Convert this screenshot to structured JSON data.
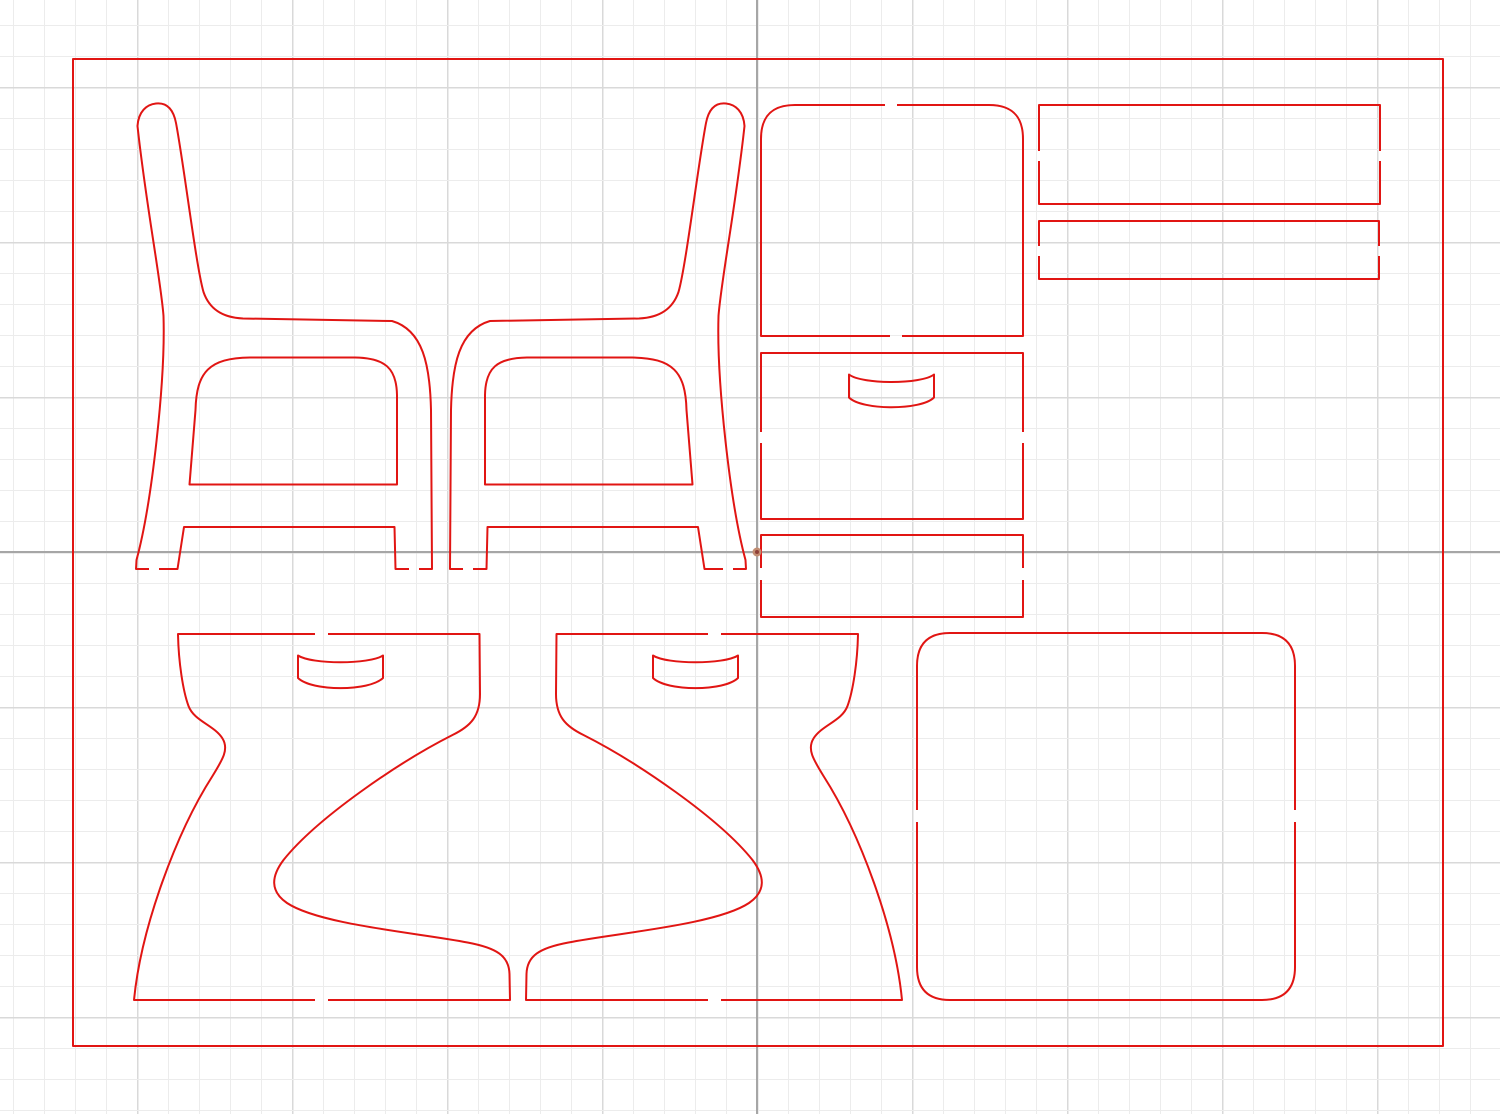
{
  "canvas": {
    "width": 1500,
    "height": 1114,
    "background": "#ffffff"
  },
  "grid": {
    "minor_spacing": 31,
    "major_spacing": 155,
    "origin_x": 757,
    "origin_y": 552,
    "minor_color": "#ececec",
    "major_color": "#d9d9d9",
    "minor_width": 1,
    "major_width": 1.5
  },
  "axes": {
    "color": "#a6a6a6",
    "width": 2,
    "vertical_x": 757,
    "horizontal_y": 552
  },
  "origin_marker": {
    "x": 757,
    "y": 552,
    "outer_r": 4.5,
    "inner_r": 2,
    "outer_color": "#c28d72",
    "inner_color": "#8e4038"
  },
  "style": {
    "cut_color": "#e11513",
    "cut_width": 2
  },
  "sheet": {
    "x": 73,
    "y": 59,
    "width": 1370,
    "height": 987
  },
  "shapes": [
    {
      "name": "sheet-border",
      "d": "M 73 59 L 1443 59 L 1443 1046 L 73 1046 Z"
    },
    {
      "name": "part-chair-side-left-outline",
      "d": "M 159 569 L 177.5 569 L 184 527 L 394.5 527 L 395.5 569 L 409 569 M 419 569 L 432 569 L 431 410 C 430 365 423 330 392 321 L 243 318.5 C 221 317.5 209 308 203.5 292 C 196 266 184 165 176 123 C 173 107.5 165.5 102.5 156 103.5 C 146.5 104.5 138.5 111.5 137.5 126 C 146 205 161 281 163.5 316 C 165.5 380 152 503 136.5 560 L 136 569 L 149 569"
    },
    {
      "name": "part-chair-side-left-window",
      "d": "M 189.5 484.5 L 195.5 410 C 196.5 372 209 358 250 357.5 L 355 357.5 C 385 358 396.5 368 397 395 L 397 484.5 Z"
    },
    {
      "name": "part-chair-side-right-outline",
      "d": "M 159 569 L 177.5 569 L 184 527 L 394.5 527 L 395.5 569 L 409 569 M 419 569 L 432 569 L 431 410 C 430 365 423 330 392 321 L 243 318.5 C 221 317.5 209 308 203.5 292 C 196 266 184 165 176 123 C 173 107.5 165.5 102.5 156 103.5 C 146.5 104.5 138.5 111.5 137.5 126 C 146 205 161 281 163.5 316 C 165.5 380 152 503 136.5 560 L 136 569 L 149 569",
      "transform": "translate(882,0) scale(-1,1)"
    },
    {
      "name": "part-chair-side-right-window",
      "d": "M 189.5 484.5 L 195.5 410 C 196.5 372 209 358 250 357.5 L 355 357.5 C 385 358 396.5 368 397 395 L 397 484.5 Z",
      "transform": "translate(882,0) scale(-1,1)"
    },
    {
      "name": "part-back-panel",
      "d": "M 897 105 L 989 105 C 1012 105 1023 116 1023 139 L 1023 336 L 902 336 M 890 336 L 761 336 L 761 139 C 761 116 772 105 795 105 L 885 105"
    },
    {
      "name": "part-rail-wide",
      "d": "M 1039 151 L 1039 105 L 1380 105 L 1380 151 M 1380 161 L 1380 204 L 1039 204 L 1039 161"
    },
    {
      "name": "part-rail-narrow",
      "d": "M 1039 246 L 1039 221 L 1379 221 L 1379 246 M 1379 256 L 1379 279 L 1039 279 L 1039 256"
    },
    {
      "name": "part-drawer-front",
      "d": "M 761 432 L 761 353 L 1023 353 L 1023 432 M 1023 443 L 1023 519 L 761 519 L 761 443"
    },
    {
      "name": "part-drawer-front-handle",
      "d": "M 849 374.5 C 862 384.5 921 384.5 934 374.5 L 934 397.5 C 921 410.5 862 410.5 849 397.5 Z"
    },
    {
      "name": "part-bottom-rail",
      "d": "M 761 568 L 761 535 L 1023 535 L 1023 568 M 1023 580 L 1023 617 L 761 617 L 761 580"
    },
    {
      "name": "part-base-side-left-outline",
      "d": "M 328 634 L 479.5 634 L 480 694 C 480 716 471 726 452.5 735 C 399 762 317 818 283.5 860 C 271.5 876 269.5 891 287 903 C 320 925 420 933 467.5 942.5 C 497 948 509 956 509.5 974 L 510 1000 L 328 1000 M 315 1000 L 134 1000 C 141 928 176 833 212.5 776 C 223 759 229 749 222.5 738.5 C 214 725 194 721 188.5 706 C 183 691 178.5 662 178 634 L 315 634"
    },
    {
      "name": "part-base-side-left-handle",
      "d": "M 298 655.5 C 312 664.5 369 664.5 383 655.5 L 383 678 C 369 691.5 312 691.5 298 678 Z"
    },
    {
      "name": "part-base-side-right-outline",
      "d": "M 328 634 L 479.5 634 L 480 694 C 480 716 471 726 452.5 735 C 399 762 317 818 283.5 860 C 271.5 876 269.5 891 287 903 C 320 925 420 933 467.5 942.5 C 497 948 509 956 509.5 974 L 510 1000 L 328 1000 M 315 1000 L 134 1000 C 141 928 176 833 212.5 776 C 223 759 229 749 222.5 738.5 C 214 725 194 721 188.5 706 C 183 691 178.5 662 178 634 L 315 634",
      "transform": "translate(1036,0) scale(-1,1)"
    },
    {
      "name": "part-base-side-right-handle",
      "d": "M 298 655.5 C 312 664.5 369 664.5 383 655.5 L 383 678 C 369 691.5 312 691.5 298 678 Z",
      "transform": "translate(1036,0) scale(-1,1)"
    },
    {
      "name": "part-seat-panel",
      "d": "M 917 810 L 917 666 C 917 644 928 633 950 633 L 1262 633 C 1284 633 1295 644 1295 666 L 1295 810 M 1295 822 L 1295 967 C 1295 989 1284 1000 1262 1000 L 950 1000 C 928 1000 917 989 917 967 L 917 822"
    }
  ]
}
